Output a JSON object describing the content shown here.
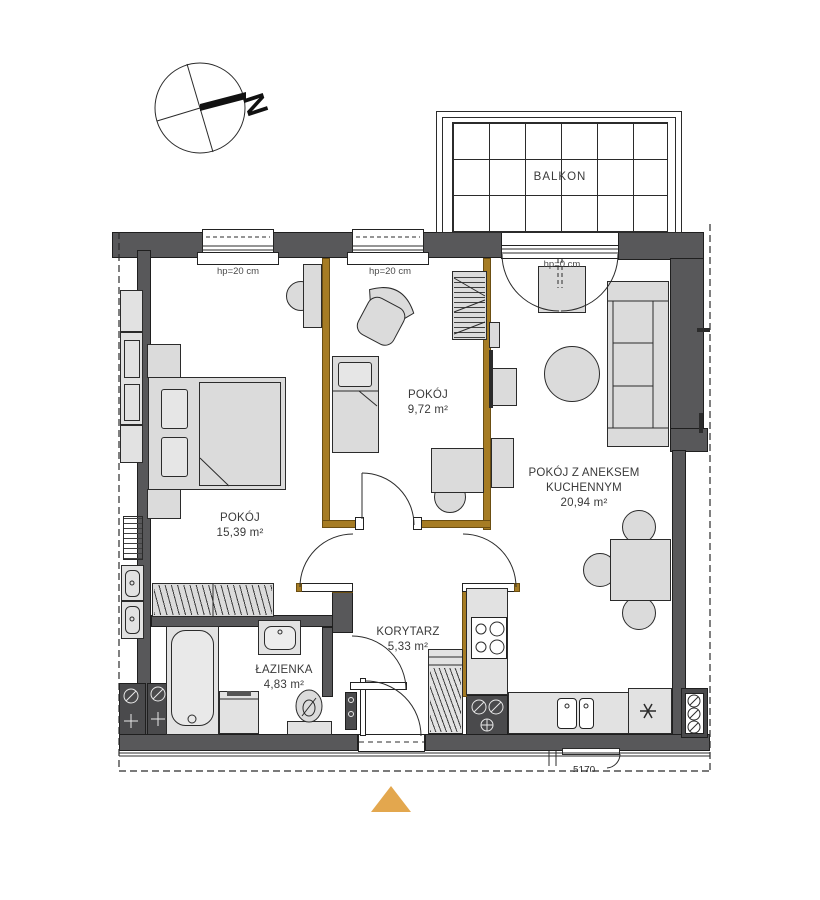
{
  "compass": {
    "north": "N"
  },
  "balcony": {
    "label": "BALKON"
  },
  "rooms": {
    "large": {
      "name": "POKÓJ",
      "area": "15,39 m²"
    },
    "small": {
      "name": "POKÓJ",
      "area": "9,72 m²"
    },
    "living": {
      "name_line1": "POKÓJ Z ANEKSEM",
      "name_line2": "KUCHENNYM",
      "area": "20,94 m²"
    },
    "corridor": {
      "name": "KORYTARZ",
      "area": "5,33 m²"
    },
    "bathroom": {
      "name": "ŁAZIENKA",
      "area": "4,83 m²"
    }
  },
  "windows": {
    "window1": "hp=20 cm",
    "window2": "hp=20 cm",
    "balcony_door": "hp=0 cm"
  },
  "annotations": {
    "neighbor_door": "5170"
  },
  "colors": {
    "wall": "#58585a",
    "partition_wall": "#a67c24",
    "furniture": "#dbdbdb",
    "entrance_marker": "#e3a74e"
  },
  "icons": {
    "compass": "compass-rose-north-needle",
    "entrance_marker": "triangle-up",
    "fridge_symbol": "snowflake-asterisk",
    "shaft_symbols": "circle-slash-valve-cross",
    "stove_symbol": "four-burners",
    "sink_symbol": "double-basin"
  }
}
